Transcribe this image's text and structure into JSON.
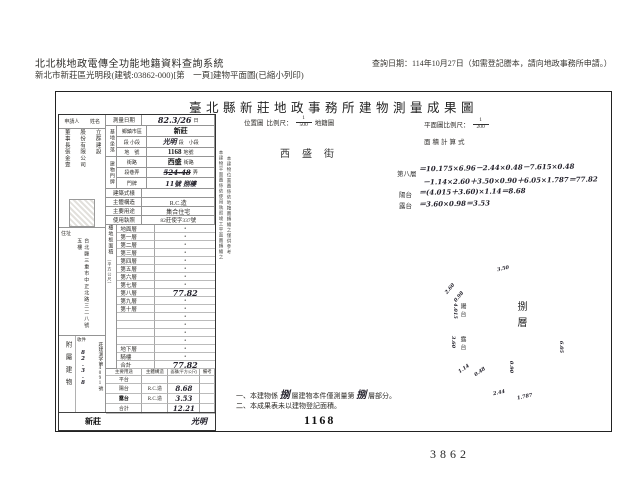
{
  "header": {
    "system_title": "北北桃地政電傳全功能地籍資料查詢系統",
    "subtitle": "新北市新莊區光明段(建號:03862-000)[第　一頁]建物平面圖(已縮小列印)",
    "query_date": "查詢日期：114年10月27日（如需登記謄本，請向地政事務所申請。）"
  },
  "doc": {
    "title": "臺北縣新莊地政事務所建物測量成果圖",
    "applicant": {
      "role": "申請人",
      "name_label": "姓名",
      "name_col1": "立群建設",
      "name_col2": "股份有限公司",
      "name_col3": "董事長張金壹",
      "addr_label": "住址",
      "address": "台北縣三重市中正北路三二八號五樓",
      "receipt_label": "收件",
      "receipt_no": "莊建測字第4091號",
      "receipt_date": "82.3.8",
      "annex_side_label": "附屬建物"
    },
    "survey": {
      "sd_l": "測量日期",
      "sd_v": "82.3/26",
      "sd_s": "日",
      "site_l": "基地坐落",
      "town_l": "鄉鎮市區",
      "town_v": "新莊",
      "sec_l": "段 小段",
      "sec_v": "光明",
      "sec_s": "段　小段",
      "lot_l": "地　號",
      "lot_v": "1168",
      "lot_s": "地號",
      "door_l": "建物門牌",
      "street_l": "街路",
      "street_v": "西盛",
      "street_s": "街路",
      "lane_l": "段巷弄",
      "lane_v": "524-48",
      "lane_s": "弄",
      "no_l": "門牌",
      "no_v": "11號 捌樓",
      "style_l": "建築式樣",
      "style_v": "",
      "struct_l": "主體構造",
      "struct_v": "R.C.造",
      "use_l": "主要用途",
      "use_v": "集合住宅",
      "lic_l": "使用執照",
      "lic_v": "82莊使字337號"
    },
    "floors": {
      "side_label": "樓地板面積",
      "side_unit": "（平方公尺）",
      "rows": [
        {
          "label": "地面層",
          "value": "•"
        },
        {
          "label": "第一層",
          "value": "•"
        },
        {
          "label": "第二層",
          "value": "•"
        },
        {
          "label": "第三層",
          "value": "•"
        },
        {
          "label": "第四層",
          "value": "•"
        },
        {
          "label": "第五層",
          "value": "•"
        },
        {
          "label": "第六層",
          "value": "•"
        },
        {
          "label": "第七層",
          "value": "•"
        },
        {
          "label": "第八層",
          "value": "77.82",
          "hw": true
        },
        {
          "label": "第九層",
          "value": "•"
        },
        {
          "label": "第十層",
          "value": "•"
        },
        {
          "label": "",
          "value": "•"
        },
        {
          "label": "",
          "value": "•"
        },
        {
          "label": "",
          "value": "•"
        },
        {
          "label": "",
          "value": "•"
        },
        {
          "label": "地下層",
          "value": "•"
        },
        {
          "label": "騎樓",
          "value": "•"
        },
        {
          "label": "合計",
          "value": "77.82",
          "hw": true
        }
      ]
    },
    "annex": {
      "headers": [
        "主要用途",
        "主體構造",
        "面積(平方公尺)",
        "備考"
      ],
      "rows": [
        {
          "use": "平台",
          "struct": "",
          "area": "",
          "note": ""
        },
        {
          "use": "陽台",
          "struct": "R.C.造",
          "area": "8.68",
          "note": ""
        },
        {
          "use": "露台",
          "struct": "R.C.造",
          "area": "3.53",
          "note": "",
          "bold": true
        },
        {
          "use": "合計",
          "struct": "",
          "area": "12.21",
          "note": ""
        }
      ]
    },
    "footer_stamps": {
      "left": "新莊",
      "right": "光明"
    },
    "side_notes": [
      "本建物平面圖係依使用執照竣工平面圖轉繪之",
      "本建物位置圖係依地籍圖轉繪之僅供參考"
    ],
    "map": {
      "loc_title": "位置圖",
      "scale_label": "比例尺：",
      "loc_num": "1",
      "loc_den": "500",
      "loc_suffix": "地籍圖",
      "plan_label": "平面圖比例尺：",
      "plan_num": "1",
      "plan_den": "200",
      "calc_title": "面積計算式",
      "street_name": "西盛街",
      "calc": [
        {
          "label": "第八層",
          "text": "＝10.175×6.96－2.44×0.48－7.615×0.48"
        },
        {
          "label": "",
          "text": "－1.14×2.60＋3.50×0.90＋6.05×1.787＝77.82"
        },
        {
          "label": "陽台",
          "text": "＝(4.015＋3.60)×1.14＝8.68"
        },
        {
          "label": "露台",
          "text": "＝3.60×0.98＝3.53"
        }
      ],
      "plan8": {
        "label": "捌層",
        "balcony_upper": "陽台",
        "balcony_lower": "露台",
        "dims": [
          "2.60",
          "0.98",
          "4.015",
          "3.60",
          "1.14",
          "0.48",
          "0.90",
          "2.44",
          "1.787",
          "6.05",
          "3.50"
        ]
      },
      "notes": {
        "n1_pre": "一、本建物係",
        "n1_hw1": "捌",
        "n1_mid": "層建物本件僅測量第",
        "n1_hw2": "捌",
        "n1_post": "層部分。",
        "n2": "二、本成果表未以建物登記面積。"
      }
    },
    "stamps": {
      "lot": "1168",
      "page": "3862"
    }
  }
}
